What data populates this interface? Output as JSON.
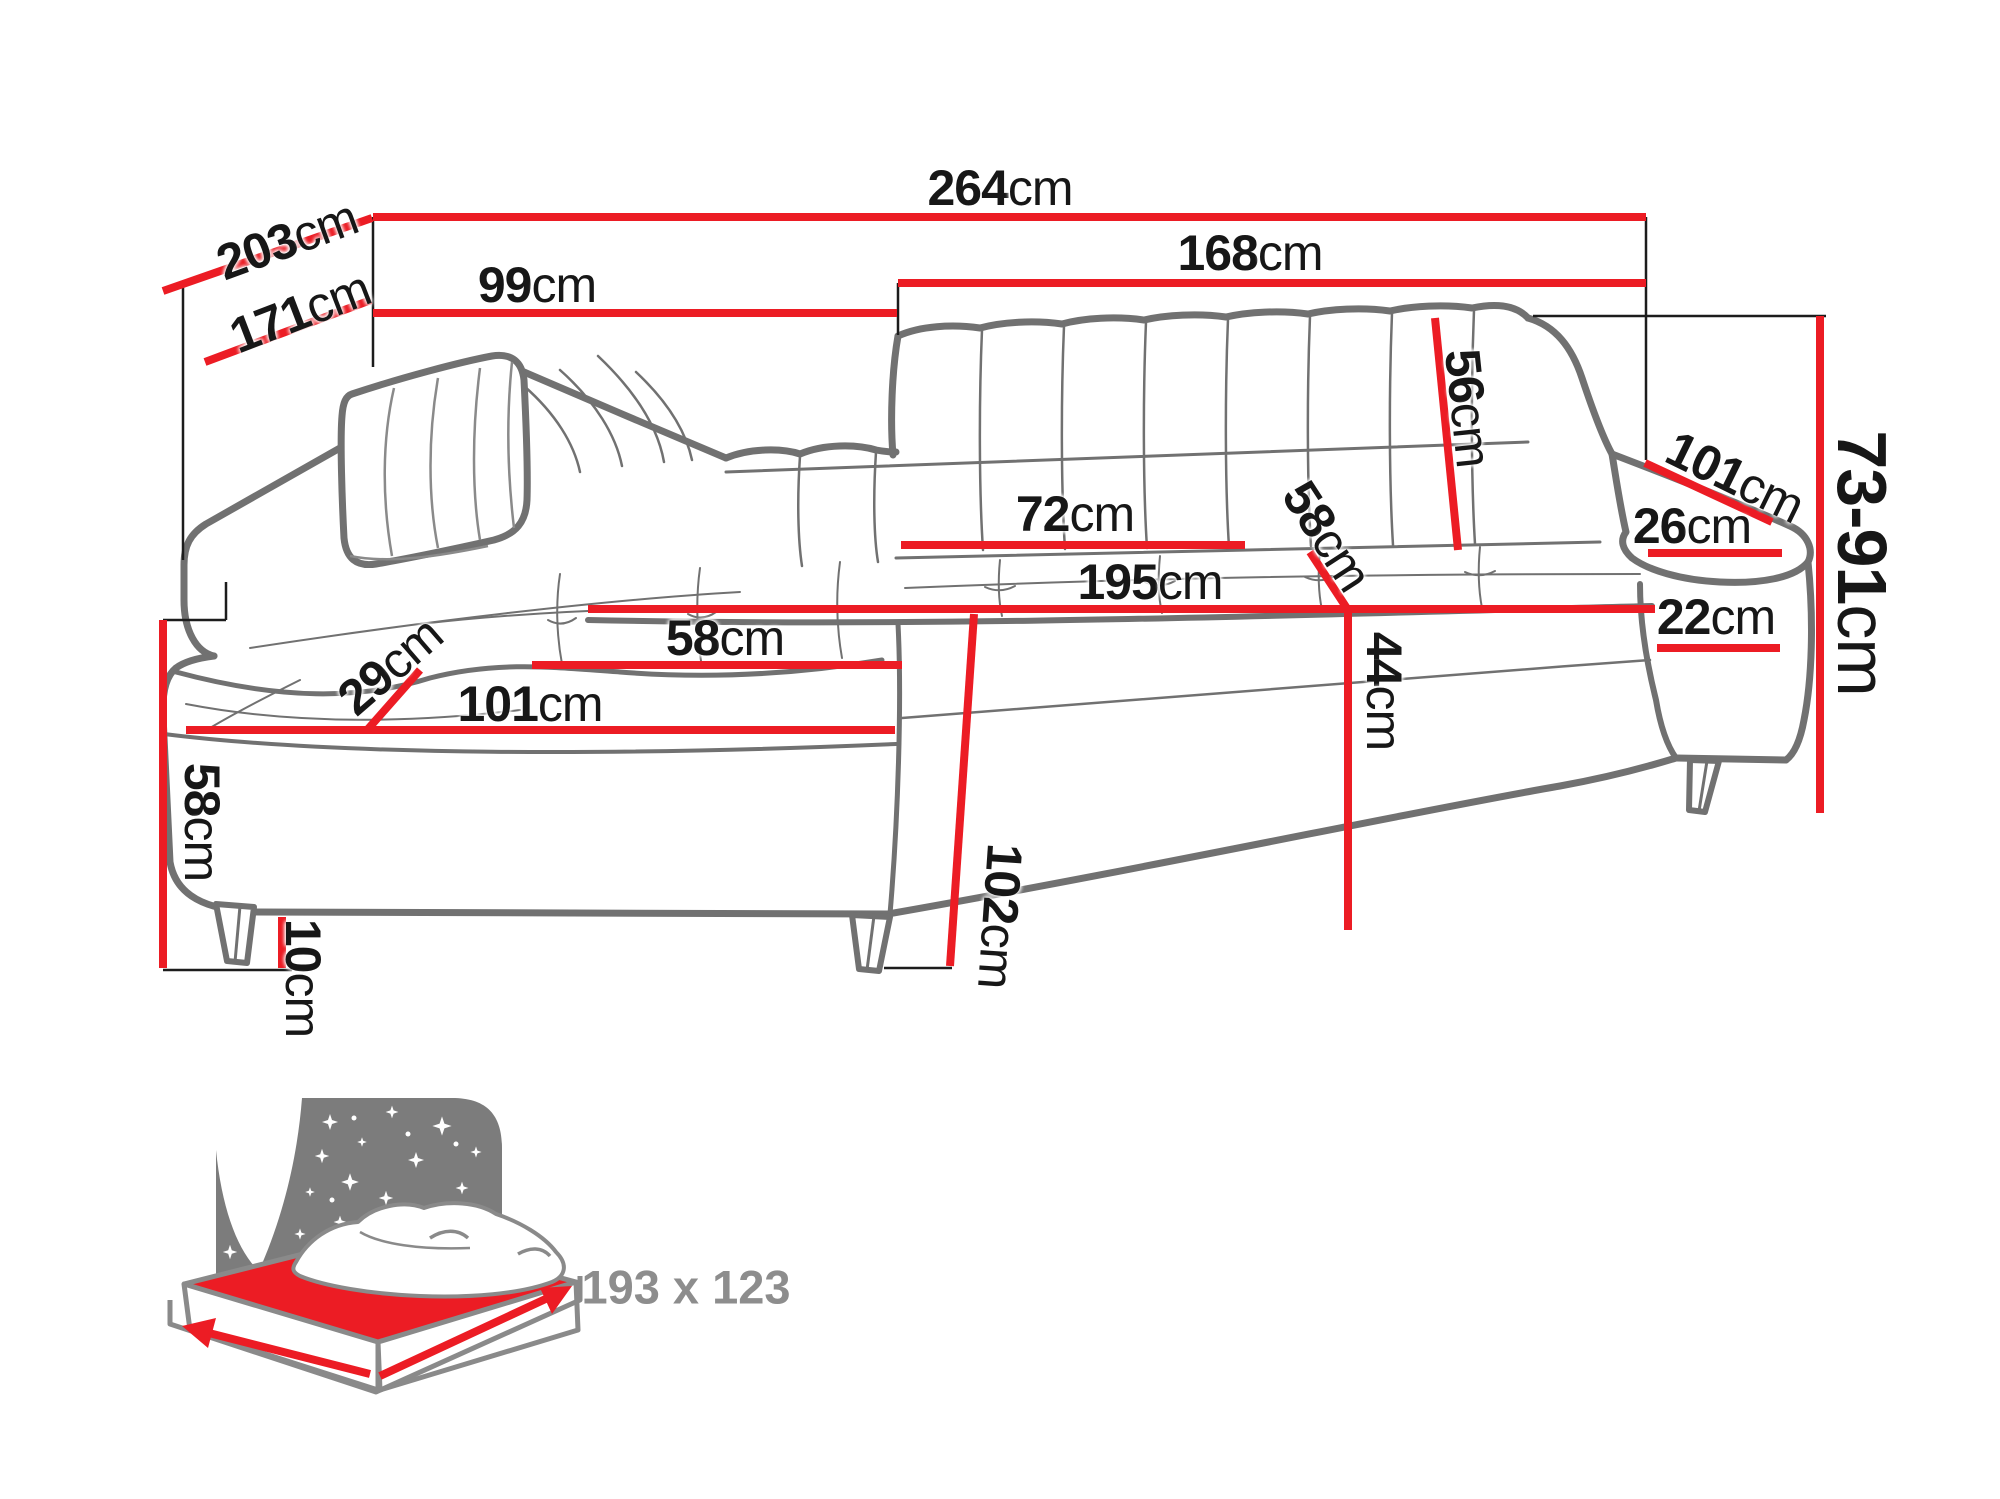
{
  "colors": {
    "dimension_red": "#ec1c24",
    "label_black": "#171717",
    "sofa_outline_gray": "#717171",
    "icon_gray": "#7c7c7c",
    "icon_text_gray": "#8d8d8d"
  },
  "dims": {
    "d264": {
      "value": "264",
      "unit": "cm"
    },
    "d203": {
      "value": "203",
      "unit": "cm"
    },
    "d171": {
      "value": "171",
      "unit": "cm"
    },
    "d99": {
      "value": "99",
      "unit": "cm"
    },
    "d168": {
      "value": "168",
      "unit": "cm"
    },
    "d56": {
      "value": "56",
      "unit": "cm"
    },
    "d72": {
      "value": "72",
      "unit": "cm"
    },
    "d58back": {
      "value": "58",
      "unit": "cm"
    },
    "d195": {
      "value": "195",
      "unit": "cm"
    },
    "d58seat": {
      "value": "58",
      "unit": "cm"
    },
    "d101seat": {
      "value": "101",
      "unit": "cm"
    },
    "d29": {
      "value": "29",
      "unit": "cm"
    },
    "d58height": {
      "value": "58",
      "unit": "cm"
    },
    "d10": {
      "value": "10",
      "unit": "cm"
    },
    "d102": {
      "value": "102",
      "unit": "cm"
    },
    "d44": {
      "value": "44",
      "unit": "cm"
    },
    "d26": {
      "value": "26",
      "unit": "cm"
    },
    "d101arm": {
      "value": "101",
      "unit": "cm"
    },
    "d22": {
      "value": "22",
      "unit": "cm"
    },
    "d7391": {
      "value": "73-91",
      "unit": "cm"
    }
  },
  "bed": {
    "size": "193 x 123"
  }
}
